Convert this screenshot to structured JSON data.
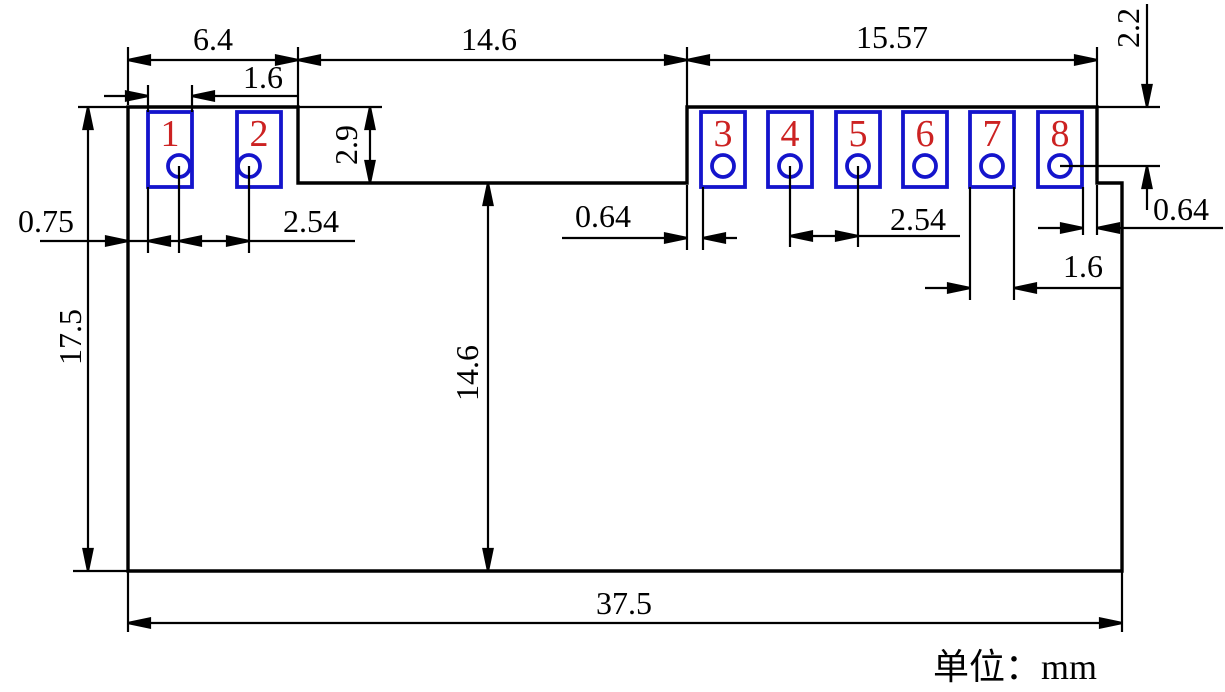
{
  "title": "PCB module dimension drawing",
  "unit_note": "单位：mm",
  "colors": {
    "line": "#000000",
    "pad_outline": "#1414cc",
    "pad_number": "#cc2222",
    "background": "#ffffff"
  },
  "pads": [
    {
      "number": "1"
    },
    {
      "number": "2"
    },
    {
      "number": "3"
    },
    {
      "number": "4"
    },
    {
      "number": "5"
    },
    {
      "number": "6"
    },
    {
      "number": "7"
    },
    {
      "number": "8"
    }
  ],
  "dims": {
    "left_tab_width": "6.4",
    "notch_width": "14.6",
    "right_tab_width": "15.57",
    "pad1_width": "1.6",
    "top_to_pin_row": "2.2",
    "notch_depth": "2.9",
    "edge_to_pad1": "0.75",
    "pitch_left": "2.54",
    "edge_to_pad3": "0.64",
    "notch_to_bottom": "14.6",
    "overall_height": "17.5",
    "pitch_right": "2.54",
    "pad8_to_edge": "0.64",
    "pad7_width": "1.6",
    "overall_width": "37.5"
  }
}
